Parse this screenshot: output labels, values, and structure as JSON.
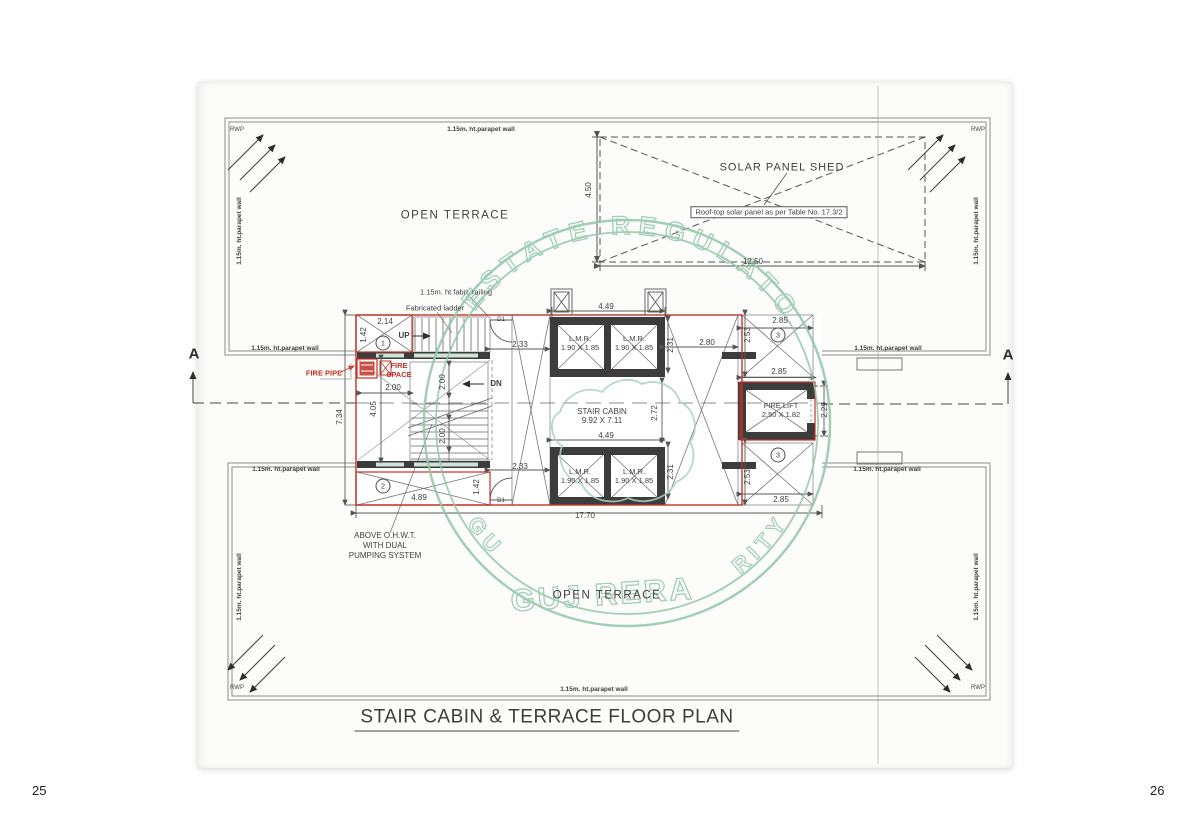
{
  "page": {
    "title": "STAIR CABIN & TERRACE FLOOR PLAN",
    "page_left": "25",
    "page_right": "26"
  },
  "watermark": {
    "arc_top": "ESTATE REGULATO",
    "arc_left": "GU",
    "arc_right": "RITY",
    "center": "GUJ RERA"
  },
  "labels": {
    "parapet": "1.15m. ht.parapet wall",
    "rwp": "RWP",
    "open_terrace": "OPEN TERRACE",
    "solar_shed": "SOLAR PANEL SHED",
    "solar_note": "Roof-top solar panel as per Table No. 17.3/2",
    "railing": "1.15m. ht fabri. railing",
    "ladder": "Fabricated ladder",
    "fire_pipe": "FIRE PIPE",
    "fire_space_line1": "FIRE",
    "fire_space_line2": "SPACE",
    "up": "UP",
    "dn": "DN",
    "door": "D1",
    "ohwt_line1": "ABOVE O.H.W.T.",
    "ohwt_line2": "WITH DUAL",
    "ohwt_line3": "PUMPING SYSTEM",
    "section_marker": "A"
  },
  "rooms": {
    "lmr": "L.M.R.",
    "lmr_size": "1.90 X 1.85",
    "stair": "STAIR CABIN",
    "stair_size": "9.92 X 7.11",
    "fire_lift": "FIRE LIFT",
    "fire_lift_size": "2.50 X 1.82"
  },
  "keys": {
    "one": "1",
    "two": "2",
    "three": "3"
  },
  "dims": {
    "solar_w": "12.50",
    "solar_h": "4.50",
    "d449": "4.49",
    "d233": "2.33",
    "d214": "2.14",
    "d142": "1.42",
    "d280": "2.80",
    "d231": "2.31",
    "d253": "2.53",
    "d285": "2.85",
    "d272": "2.72",
    "d229": "2.29",
    "d200": "2.00",
    "d405": "4.05",
    "d489": "4.89",
    "d734": "7.34",
    "d1770": "17.70"
  },
  "colors": {
    "red": "#c13327",
    "wall": "#3c3c3c",
    "watermark_green": "#93c7a8",
    "line": "#555555"
  }
}
